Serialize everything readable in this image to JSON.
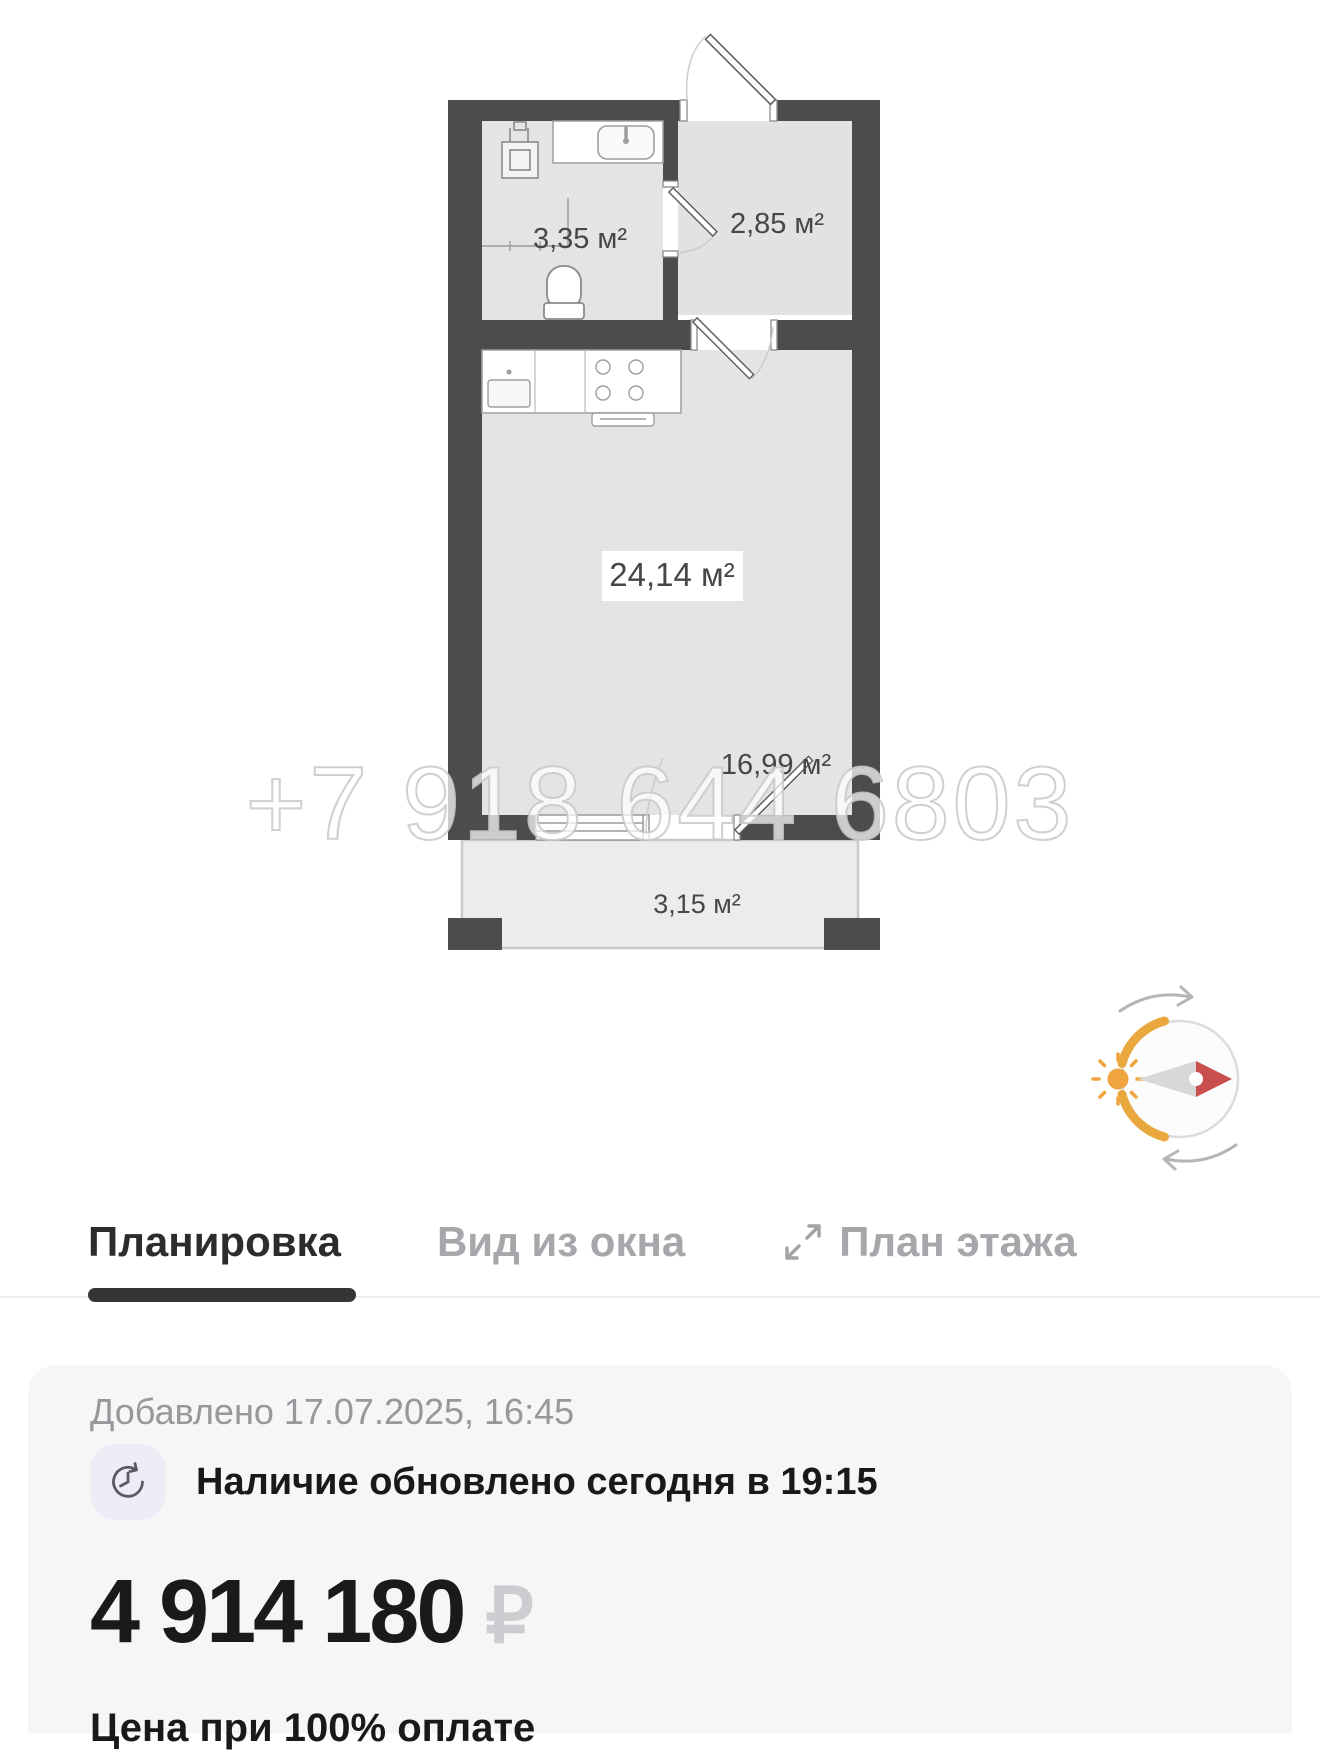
{
  "floor_plan": {
    "watermark": "+7 918 644 6803",
    "rooms": [
      {
        "name": "bathroom",
        "area_label": "3,35 м²"
      },
      {
        "name": "hallway",
        "area_label": "2,85 м²"
      },
      {
        "name": "main-room",
        "area_label": "24,14 м²"
      },
      {
        "name": "living-zone",
        "area_label": "16,99 м²"
      },
      {
        "name": "balcony",
        "area_label": "3,15 м²"
      }
    ],
    "colors": {
      "wall": "#4c4c4c",
      "room_fill": "#e4e4e4",
      "balcony_fill": "#ececec"
    }
  },
  "compass": {
    "colors": {
      "arc": "#e9a83e",
      "sun": "#efa43e",
      "needle_red": "#c94f4c",
      "needle_gray": "#d8d8d8"
    }
  },
  "tabs": [
    {
      "label": "Планировка",
      "active": true
    },
    {
      "label": "Вид из окна",
      "active": false
    },
    {
      "label": "План этажа",
      "active": false,
      "icon": "expand-icon"
    }
  ],
  "details": {
    "added": "Добавлено 17.07.2025, 16:45",
    "availability": "Наличие обновлено сегодня в 19:15",
    "price": "4 914 180",
    "currency": "₽",
    "price_note": "Цена при 100% оплате"
  }
}
